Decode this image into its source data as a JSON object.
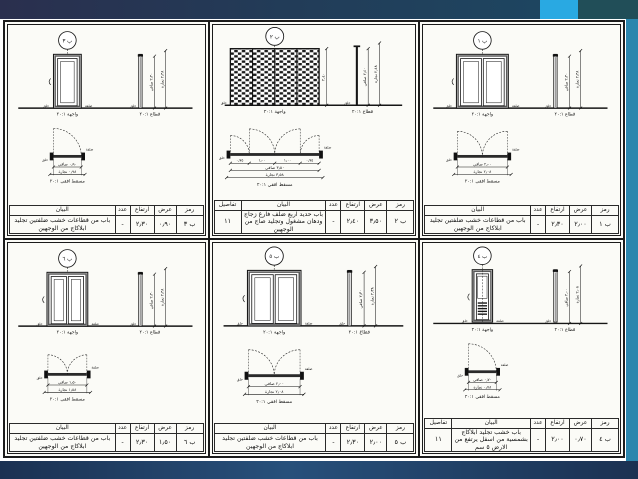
{
  "slide": {
    "top_bar_color": "#223c58",
    "accent_cyan": "#29a9e2",
    "corner_teal": "#214e58",
    "right_stripe_color": "#2b86ad",
    "bottom_bar_color": "#1f3a62",
    "paper_color": "#fbfbf7"
  },
  "shared": {
    "headers": {
      "code": "رمز",
      "width": "عرض",
      "height": "ارتفاع",
      "count": "عدد",
      "description": "البيان",
      "details": "تفاصيل"
    },
    "labels": {
      "elevation": "واجهة ٢٠:١",
      "section": "قطاع ٢٠:١",
      "plan": "مسقط افقي ٢٠:١",
      "frame": "حلق",
      "leaf": "ضلفة"
    }
  },
  "panels": [
    {
      "code": "ب ٣",
      "type": "wood-single-leaf",
      "dims": {
        "w_clear": "٠٫٩٠ صافي",
        "w_carp": "٠٫٩٨ نجارة",
        "h_clear": "٢٫٣٠ صافي",
        "h_carp": "٢٫٣٨ نجارة"
      },
      "row": {
        "code": "ب ٣",
        "width": "٠٫٩٠",
        "height": "٢٫٣٠",
        "count": "-",
        "description": "باب من قطاعات خشب ضلفتين تجليد ابلاكاج من الوجهين",
        "details": ""
      }
    },
    {
      "code": "ب ٢",
      "type": "steel-four-leaf-grille",
      "dims": {
        "w_clear": "٣٫٥٠ صافي",
        "w_carp": "٣٫٥٨ نجارة",
        "h_clear": "٢٫٤٠ صافي",
        "h_carp": "٢٫٤٨ نجارة",
        "h_side": "٢٫٤٠",
        "segments": [
          "٠٫٧٥",
          "١٫٠٠",
          "١٫٠٠",
          "٠٫٧٥"
        ]
      },
      "row": {
        "code": "ب ٢",
        "width": "٣٫٥٠",
        "height": "٢٫٤٠",
        "count": "-",
        "description": "باب حديد اربع ضلف فارغ زجاج ودهان مشغول وتجليد صاج من الوجهين",
        "details": "١١"
      }
    },
    {
      "code": "ب ١",
      "type": "wood-double-leaf",
      "dims": {
        "w_clear": "٢٫٠٠ صافي",
        "w_carp": "٢٫٠٨ نجارة",
        "h_clear": "٢٫٣٠ صافي",
        "h_carp": "٢٫٣٨ نجارة"
      },
      "row": {
        "code": "ب ١",
        "width": "٢٫٠٠",
        "height": "٢٫٣٠",
        "count": "-",
        "description": "باب من قطاعات خشب ضلفتين تجليد ابلاكاج من الوجهين",
        "details": ""
      }
    },
    {
      "code": "ب ٦",
      "type": "wood-double-leaf",
      "dims": {
        "w_clear": "١٫٥٠ صافي",
        "w_carp": "١٫٥٨ نجارة",
        "h_clear": "٢٫٣٠ صافي",
        "h_carp": "٢٫٣٨ نجارة"
      },
      "row": {
        "code": "ب ٦",
        "width": "١٫٥٠",
        "height": "٢٫٣٠",
        "count": "-",
        "description": "باب من قطاعات خشب ضلفتين تجليد ابلاكاج من الوجهين",
        "details": ""
      }
    },
    {
      "code": "ب ٥",
      "type": "wood-double-leaf",
      "dims": {
        "w_clear": "٢٫٠٠ صافي",
        "w_carp": "٢٫٠٨ نجارة",
        "h_clear": "٢٫٣٠ صافي",
        "h_carp": "٢٫٣٨ نجارة"
      },
      "row": {
        "code": "ب ٥",
        "width": "٢٫٠٠",
        "height": "٢٫٣٠",
        "count": "-",
        "description": "باب من قطاعات خشب ضلفتين تجليد ابلاكاج من الوجهين",
        "details": ""
      }
    },
    {
      "code": "ب ٤",
      "type": "wood-louver-bottom",
      "dims": {
        "w_clear": "٠٫٧٠ صافي",
        "w_carp": "٠٫٧٨ نجارة",
        "h_clear": "٢٫٠٠ صافي",
        "h_carp": "٢٫٠٨ نجارة"
      },
      "row": {
        "code": "ب ٤",
        "width": "٠٫٧٠",
        "height": "٢٫٠٠",
        "count": "-",
        "description": "باب خشب تجليد ابلاكاج بشمسية من اسفل يرتفع من الارض ٥ سم",
        "details": "١١"
      }
    }
  ]
}
